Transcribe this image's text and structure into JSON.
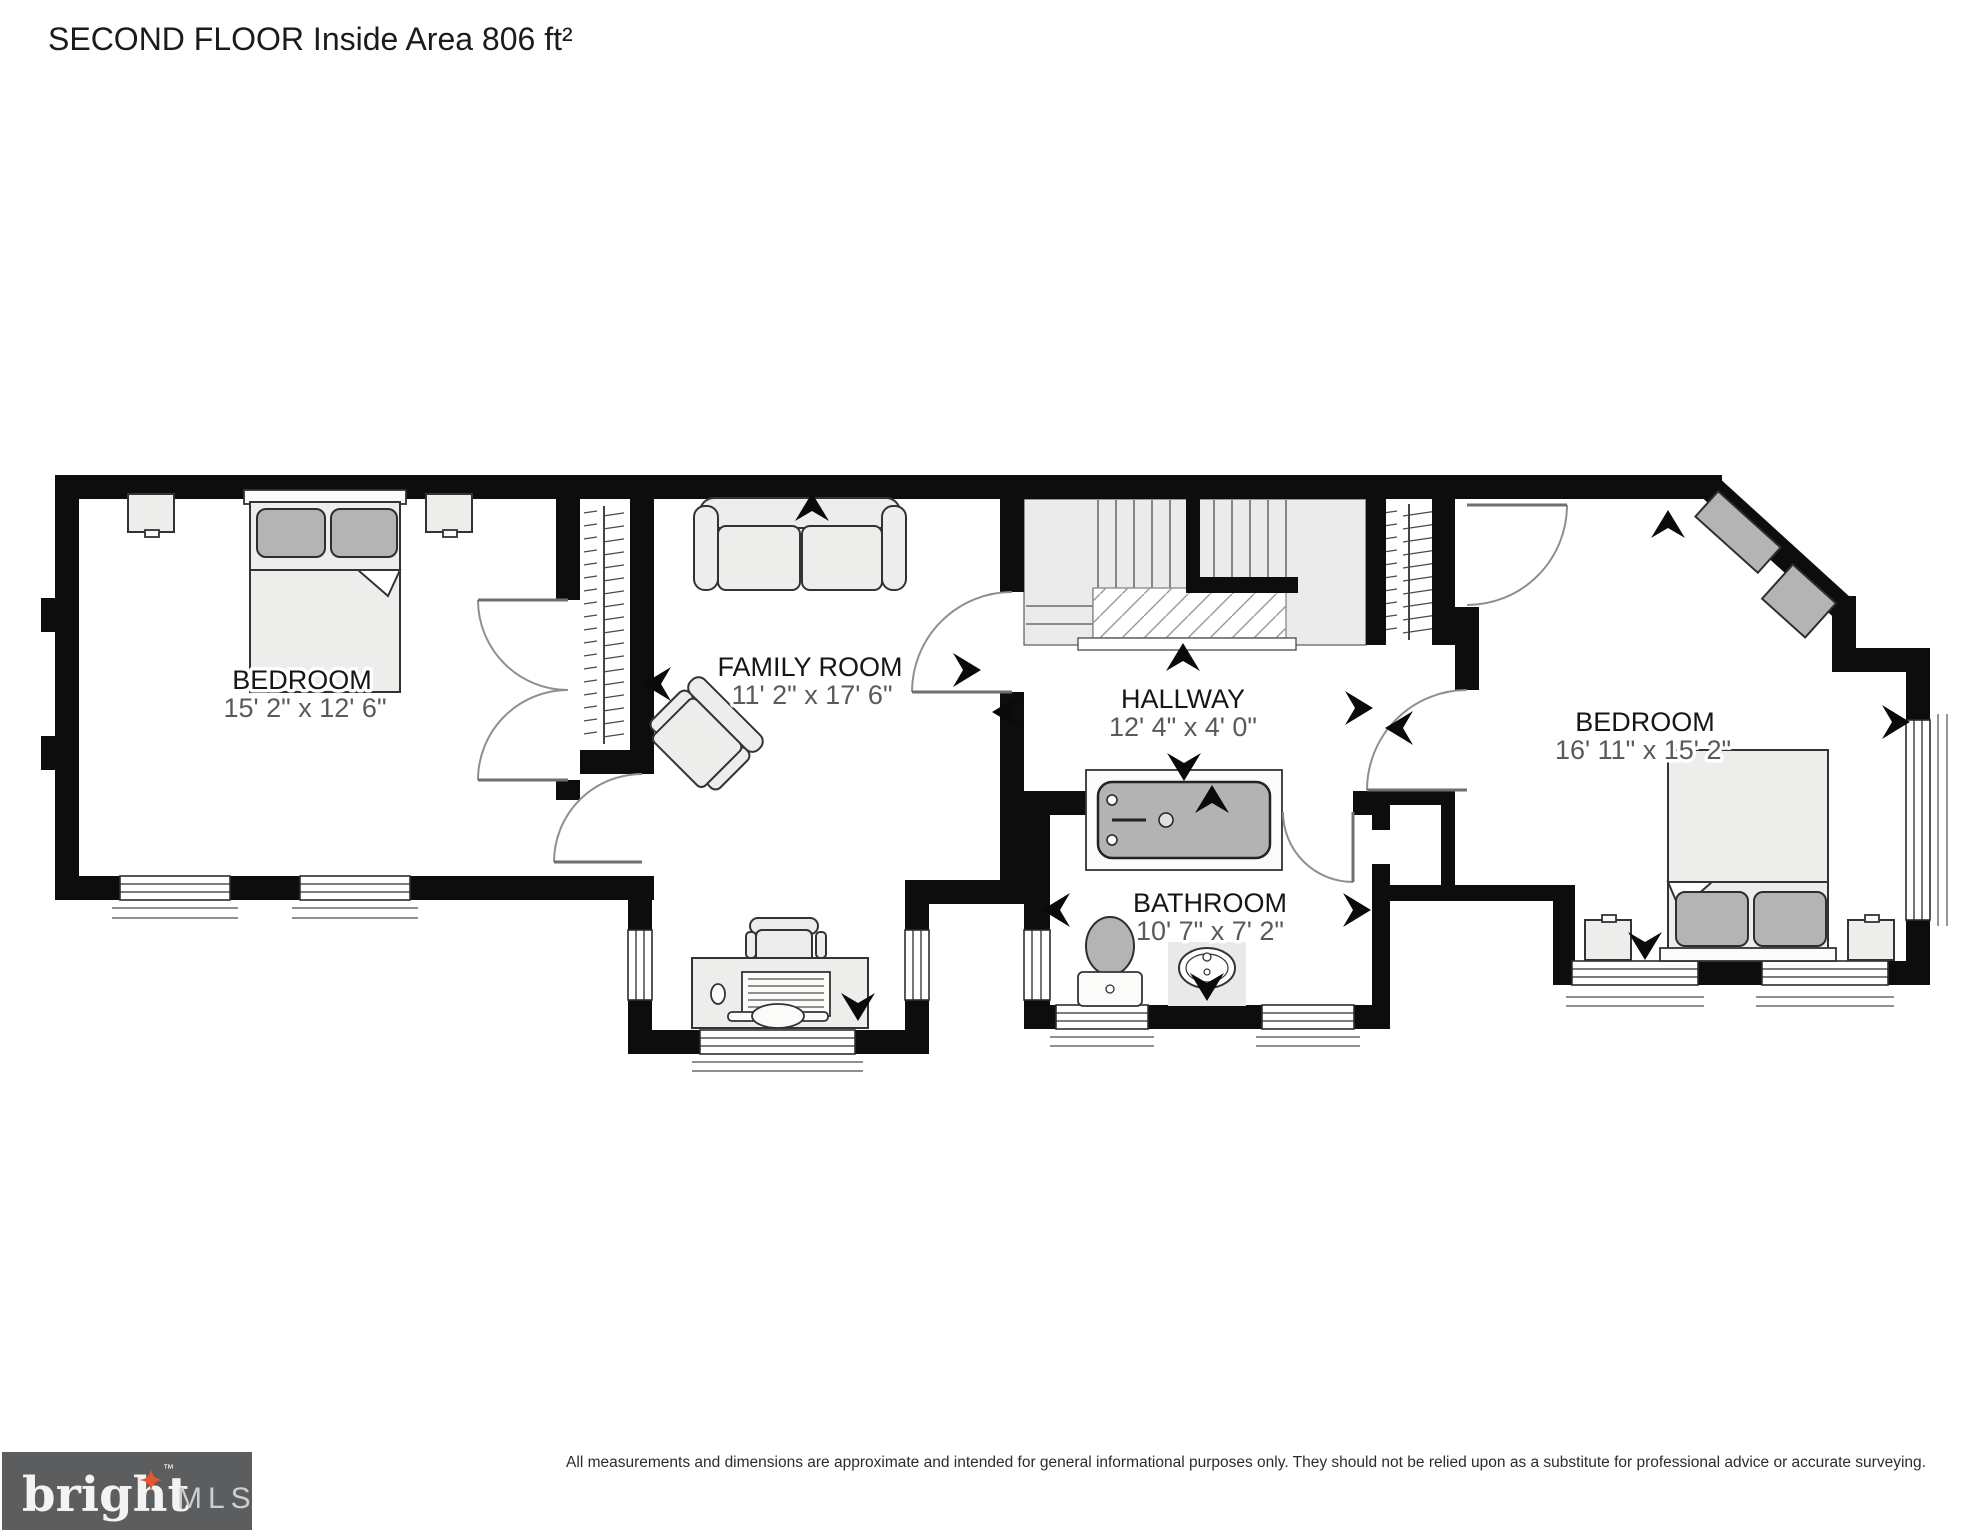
{
  "title": "SECOND FLOOR Inside Area 806 ft²",
  "rooms": {
    "bedroom_left": {
      "name": "BEDROOM",
      "dims": "15' 2\" x 12' 6\""
    },
    "family_room": {
      "name": "FAMILY ROOM",
      "dims": "11' 2\" x 17' 6\""
    },
    "hallway": {
      "name": "HALLWAY",
      "dims": "12' 4\" x 4' 0\""
    },
    "bathroom": {
      "name": "BATHROOM",
      "dims": "10' 7\" x 7' 2\""
    },
    "bedroom_right": {
      "name": "BEDROOM",
      "dims": "16' 11\" x 15' 2\""
    }
  },
  "footer": {
    "disclaimer": "All measurements and dimensions are approximate and intended for general informational purposes only. They should not be relied upon as a substitute for professional advice or accurate surveying.",
    "logo": {
      "brand": "bright",
      "tm": "™",
      "suffix": "MLS"
    }
  },
  "colors": {
    "wall": "#0d0d0d",
    "furniture_fill": "#ededeb",
    "fixture_gray": "#b4b4b4",
    "logo_bg": "#5b5d5f",
    "logo_star": "#e8562d",
    "label_dim": "#5a5a5a"
  }
}
